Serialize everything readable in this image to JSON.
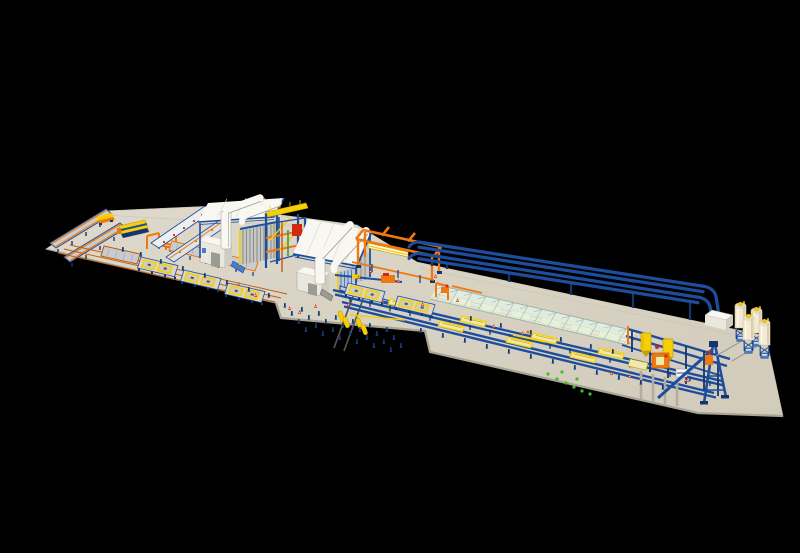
{
  "scene": {
    "label": "isometric 3d render of an aac block plant production line on a black background",
    "background": "#000000",
    "components": [
      {
        "name": "finished-product-platform",
        "count": 1
      },
      {
        "name": "transfer-cart-tracks",
        "count": 2
      },
      {
        "name": "packing-machine",
        "count": 1
      },
      {
        "name": "transfer-cart",
        "count": 1
      },
      {
        "name": "orange-roller-conveyors",
        "count": 3
      },
      {
        "name": "tilting-tables",
        "count": 2
      },
      {
        "name": "mold-pallets-with-yellow-frames",
        "count": 6
      },
      {
        "name": "curing-chambers",
        "count": 2
      },
      {
        "name": "roof-ducts-per-chamber",
        "count": 2
      },
      {
        "name": "transfer-tower",
        "count": 1
      },
      {
        "name": "orange-gantry-crane",
        "count": 1
      },
      {
        "name": "elevated-slurry-pipes",
        "count": 4
      },
      {
        "name": "pre-curing-gallery",
        "count": 1
      },
      {
        "name": "mold-conveyor-rail-lines",
        "count": 2
      },
      {
        "name": "rail-molds",
        "count": 7
      },
      {
        "name": "mixing-tower",
        "count": 1
      },
      {
        "name": "day-tanks",
        "count": 2
      },
      {
        "name": "pouring-mixer",
        "count": 1
      },
      {
        "name": "hoist-a-frame",
        "count": 1
      },
      {
        "name": "control-room",
        "count": 1
      },
      {
        "name": "cement-silos",
        "count": 4
      },
      {
        "name": "safety-cones",
        "count": 16
      },
      {
        "name": "floor-bollards",
        "count": 60
      },
      {
        "name": "green-markers",
        "count": 8
      }
    ]
  },
  "palette": {
    "bg": "#000000",
    "floor": "#dbd6c8",
    "floordark": "#d2ccbb",
    "flooredge": "#a8a496",
    "blue": "#1d4e9e",
    "navy": "#16356f",
    "ltblue": "#4a7cc8",
    "orange": "#f0780f",
    "dkorange": "#c05a08",
    "yellow": "#f7cf06",
    "dkyellow": "#c79f00",
    "paleyellow": "#f0e9ae",
    "white": "#f9f7f1",
    "offwhite": "#eae7dd",
    "shade": "#cfccc2",
    "gray": "#9b9b94",
    "dkgray": "#56564f",
    "louver": "#c6c7c2",
    "louverline": "#8a8c8a",
    "louverb": "#b9c6d8",
    "louverbline": "#5578a8",
    "red": "#d02812",
    "green": "#3fbf2a",
    "glass": "#e4f2e9",
    "glassline": "#9db4a8",
    "silo": "#f2ead2",
    "siloshade": "#d0c29a",
    "steel": "#c9ccce",
    "pillar": "#b2ad9f"
  }
}
